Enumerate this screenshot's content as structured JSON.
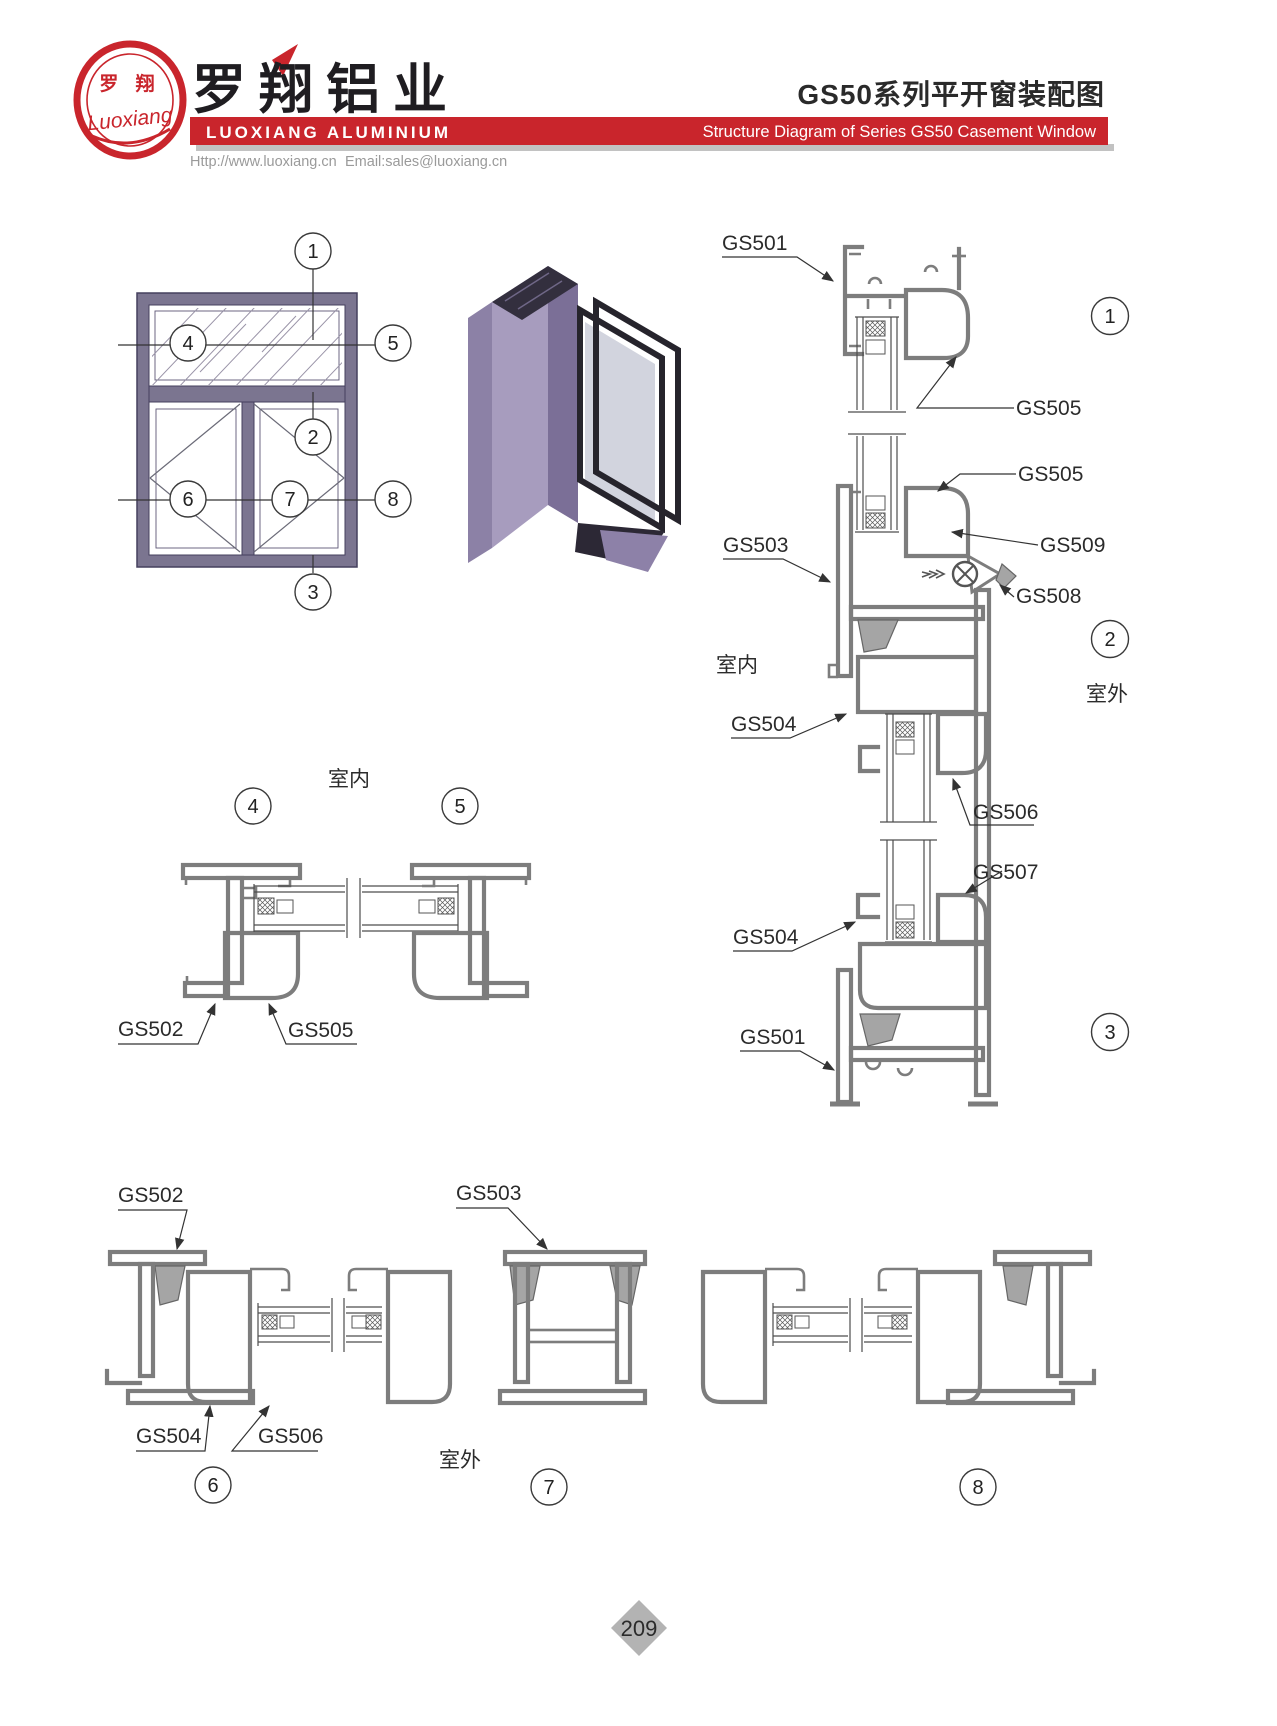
{
  "header": {
    "logo_cn": "罗 翔",
    "logo_script": "Luoxiang",
    "company_cn": "罗翔铝业",
    "company_en": "LUOXIANG ALUMINIUM",
    "website": "Http://www.luoxiang.cn",
    "email": "Email:sales@luoxiang.cn",
    "title_cn": "GS50系列平开窗装配图",
    "title_en": "Structure Diagram of Series GS50 Casement Window",
    "brand_red": "#c9252c"
  },
  "colors": {
    "profile_gray": "#7d7d7d",
    "elevation_purple": "#7b7590",
    "render_lavender": "#a79cbe",
    "diamond_gray": "#b3b3b3"
  },
  "elevation": {
    "callouts": {
      "c1": "1",
      "c2": "2",
      "c3": "3",
      "c4": "4",
      "c5": "5",
      "c6": "6",
      "c7": "7",
      "c8": "8"
    }
  },
  "section_v": {
    "gs501_top": "GS501",
    "gs505_a": "GS505",
    "gs505_b": "GS505",
    "gs503": "GS503",
    "gs509": "GS509",
    "gs508": "GS508",
    "gs504_a": "GS504",
    "gs506": "GS506",
    "gs507": "GS507",
    "gs504_b": "GS504",
    "gs501_bottom": "GS501",
    "indoor": "室内",
    "outdoor": "室外",
    "c1": "1",
    "c2": "2",
    "c3": "3"
  },
  "section_mid": {
    "indoor": "室内",
    "c4": "4",
    "c5": "5",
    "gs502": "GS502",
    "gs505": "GS505"
  },
  "section_bottom": {
    "gs502": "GS502",
    "gs503": "GS503",
    "gs504": "GS504",
    "gs506": "GS506",
    "outdoor": "室外",
    "c6": "6",
    "c7": "7",
    "c8": "8"
  },
  "footer": {
    "page_number": "209"
  }
}
